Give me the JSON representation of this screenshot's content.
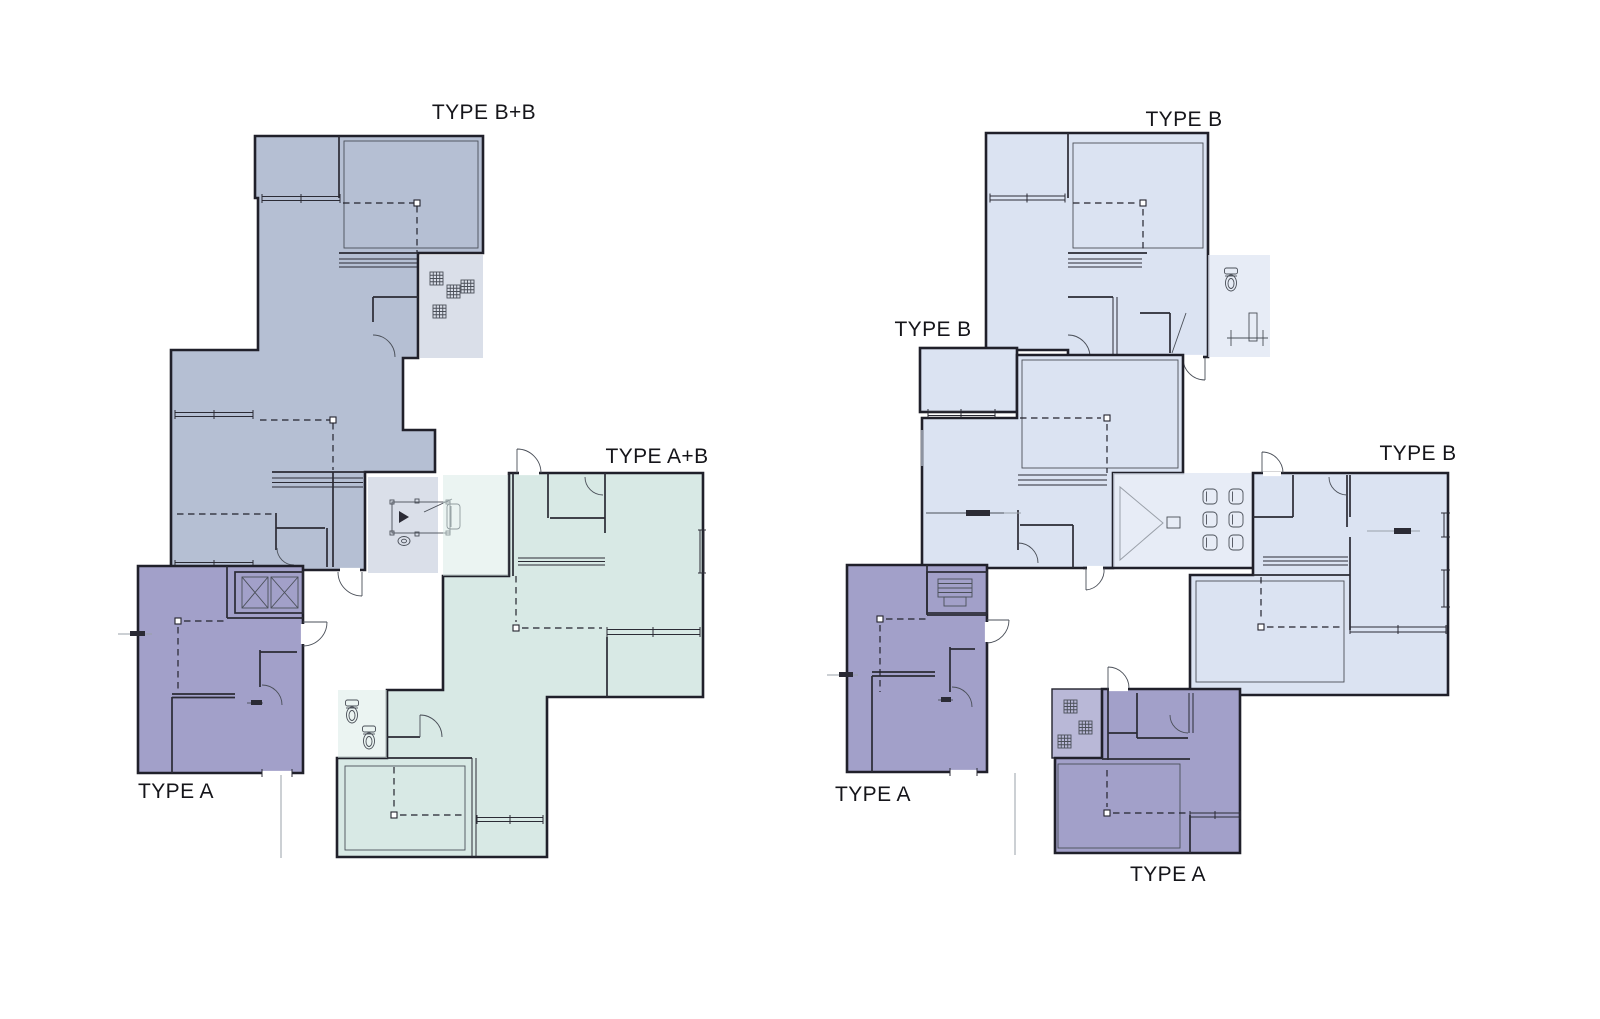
{
  "diagram": {
    "type": "architectural-floor-plan",
    "colors": {
      "background": "#ffffff",
      "wall": "#20202a",
      "unit_bb_grayblue": "#b5bfd3",
      "unit_a_purple": "#a2a0c9",
      "unit_ab_teal": "#d8e9e5",
      "unit_b_blue": "#dbe3f2",
      "elevator_fill": "#c9cbe3",
      "label_text": "#15151a"
    },
    "left_plan": {
      "labels": {
        "bb": "TYPE B+B",
        "ab": "TYPE A+B",
        "a": "TYPE A"
      }
    },
    "right_plan": {
      "labels": {
        "b_top": "TYPE B",
        "b_mid": "TYPE B",
        "b_right": "TYPE B",
        "a_left": "TYPE A",
        "a_right": "TYPE A"
      }
    },
    "icons": [
      "pool-table-icon",
      "toilet-icon",
      "planter-grid-icon",
      "elevator-core-icon",
      "stairs-triangle-icon",
      "dining-chair-icon",
      "gym-bench-icon",
      "kitchen-counter-icon",
      "door-swing-icon",
      "window-icon"
    ]
  }
}
